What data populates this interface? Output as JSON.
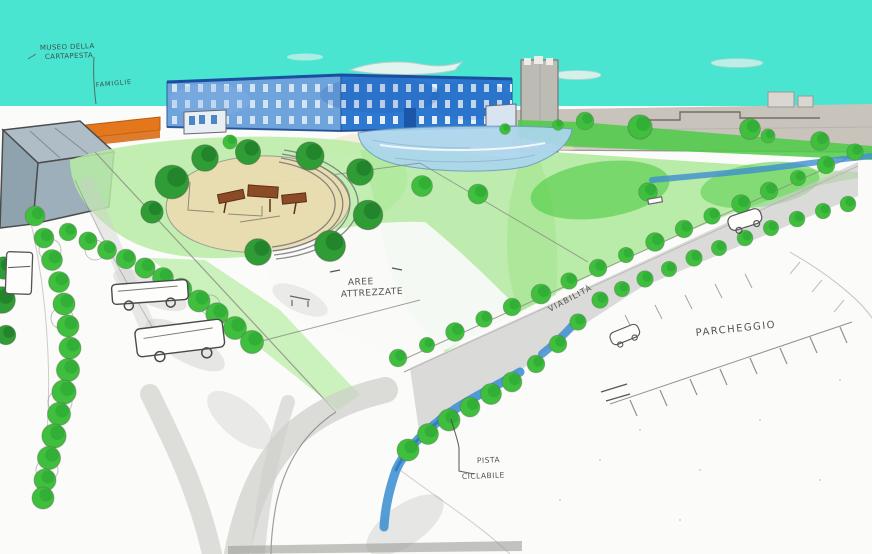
{
  "scene": {
    "description": "Hand-drawn urban park masterplan perspective sketch",
    "labels": {
      "museum": {
        "line1": "MUSEO DELLA",
        "line2": "CARTAPESTA"
      },
      "building": {
        "text": "FAMIGLIE"
      },
      "equipped_areas": {
        "line1": "AREE",
        "line2": "ATTREZZATE"
      },
      "roads": {
        "text": "VIABILITÀ"
      },
      "parking": {
        "text": "PARCHEGGIO"
      },
      "bike_path": {
        "line1": "PISTA",
        "line2": "CICLABILE"
      }
    },
    "palette": {
      "sky": "#49E5D1",
      "building_blue": "#2E79D0",
      "building_blue_light": "#6FA3DC",
      "lawn_light": "#B7ECA4",
      "lawn_bright": "#4CCB45",
      "tree_green": "#3FBF3D",
      "tree_dark_green": "#2F9C36",
      "water": "#3E8FD0",
      "pond": "#ABD6EE",
      "sand": "#EBDCB2",
      "road_gray": "#CDCDCA",
      "wall_orange": "#E4761B",
      "background_gray": "#C8C4BB",
      "paper": "#FBFBF9",
      "ink": "#3D3B37",
      "museum_ink": "#74362A"
    }
  }
}
